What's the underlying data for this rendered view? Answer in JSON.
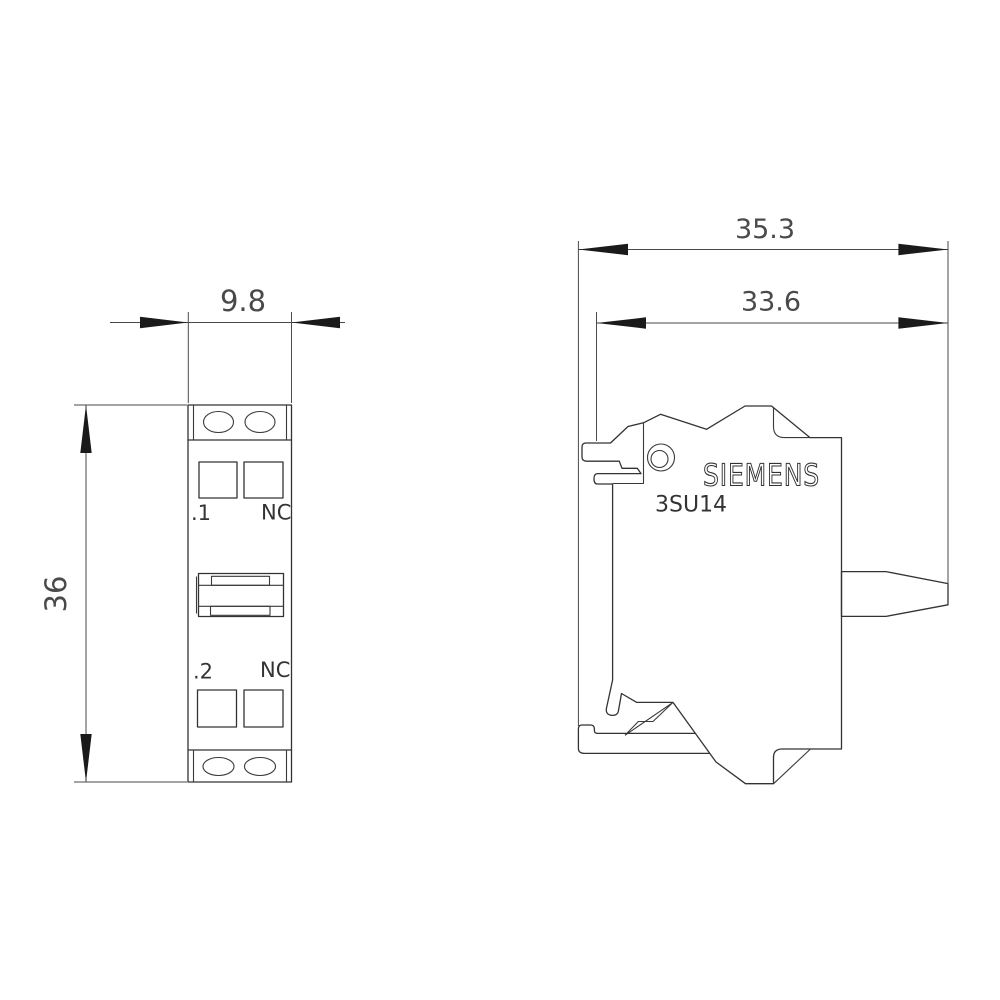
{
  "drawing": {
    "brand_label": "SIEMENS",
    "product_code": "3SU14",
    "front_view": {
      "width_dim": "9.8",
      "height_dim": "36",
      "contact_row1_left": ".1",
      "contact_row1_right": "NC",
      "contact_row2_left": ".2",
      "contact_row2_right": "NC"
    },
    "side_view": {
      "overall_depth_dim": "35.3",
      "body_depth_dim": "33.6"
    },
    "colors": {
      "line": "#333333",
      "dim_text": "#4a4a4a",
      "label_text": "#333333",
      "arrow_fill": "#1a1a1a",
      "background": "#ffffff"
    }
  }
}
